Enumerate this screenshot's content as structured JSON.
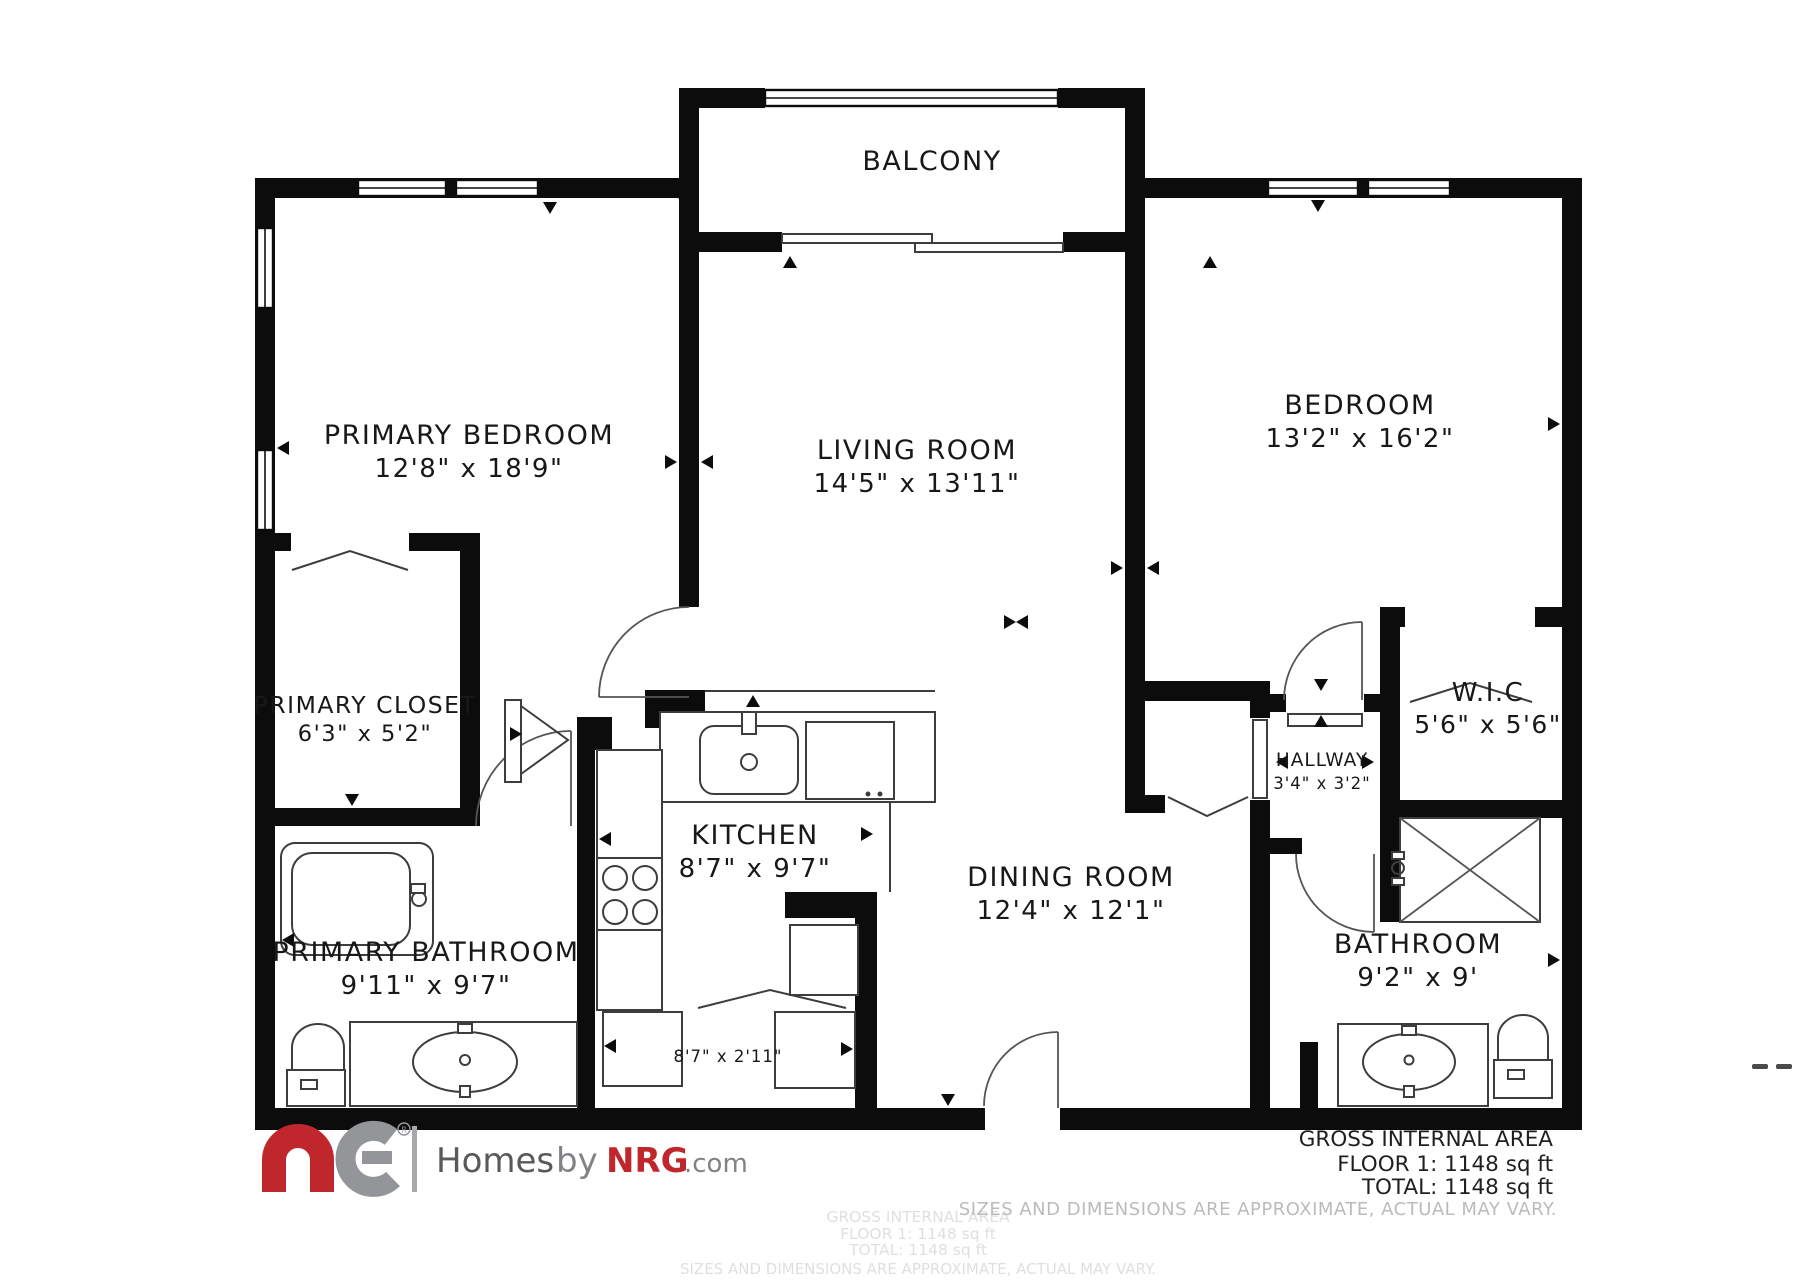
{
  "plan": {
    "balcony": {
      "label": "BALCONY"
    },
    "rooms": [
      {
        "id": "primary-bedroom",
        "name": "PRIMARY BEDROOM",
        "dims": "12'8\" x 18'9\""
      },
      {
        "id": "living-room",
        "name": "LIVING ROOM",
        "dims": "14'5\" x 13'11\""
      },
      {
        "id": "bedroom",
        "name": "BEDROOM",
        "dims": "13'2\" x 16'2\""
      },
      {
        "id": "primary-closet",
        "name": "PRIMARY CLOSET",
        "dims": "6'3\" x 5'2\""
      },
      {
        "id": "wic",
        "name": "W.I.C",
        "dims": "5'6\" x 5'6\""
      },
      {
        "id": "hallway",
        "name": "HALLWAY",
        "dims": "3'4\" x 3'2\""
      },
      {
        "id": "kitchen",
        "name": "KITCHEN",
        "dims": "8'7\" x 9'7\""
      },
      {
        "id": "dining-room",
        "name": "DINING ROOM",
        "dims": "12'4\" x 12'1\""
      },
      {
        "id": "primary-bathroom",
        "name": "PRIMARY BATHROOM",
        "dims": "9'11\" x 9'7\""
      },
      {
        "id": "bathroom",
        "name": "BATHROOM",
        "dims": "9'2\" x 9'"
      }
    ],
    "laundry_nook_dims": "8'7\" x 2'11\""
  },
  "footer": {
    "logo": {
      "mark": "NRG",
      "homes": "Homes",
      "by": "by",
      "brand": "NRG",
      "domain": ".com",
      "registered": "R"
    },
    "area": {
      "title": "GROSS INTERNAL AREA",
      "floor": "FLOOR 1: 1148 sq ft",
      "total": "TOTAL: 1148 sq ft",
      "disclaimer": "SIZES AND DIMENSIONS ARE APPROXIMATE, ACTUAL MAY VARY."
    },
    "watermark_lines": [
      "GROSS INTERNAL AREA",
      "FLOOR 1: 1148 sq ft",
      "TOTAL: 1148 sq ft",
      "SIZES AND DIMENSIONS ARE APPROXIMATE, ACTUAL MAY VARY."
    ]
  },
  "colors": {
    "walls": "#0c0c0c",
    "brand_red": "#c0272d",
    "logo_gray": "#939598",
    "text_dark": "#58595b",
    "disclaimer_gray": "#b9bbbd"
  }
}
